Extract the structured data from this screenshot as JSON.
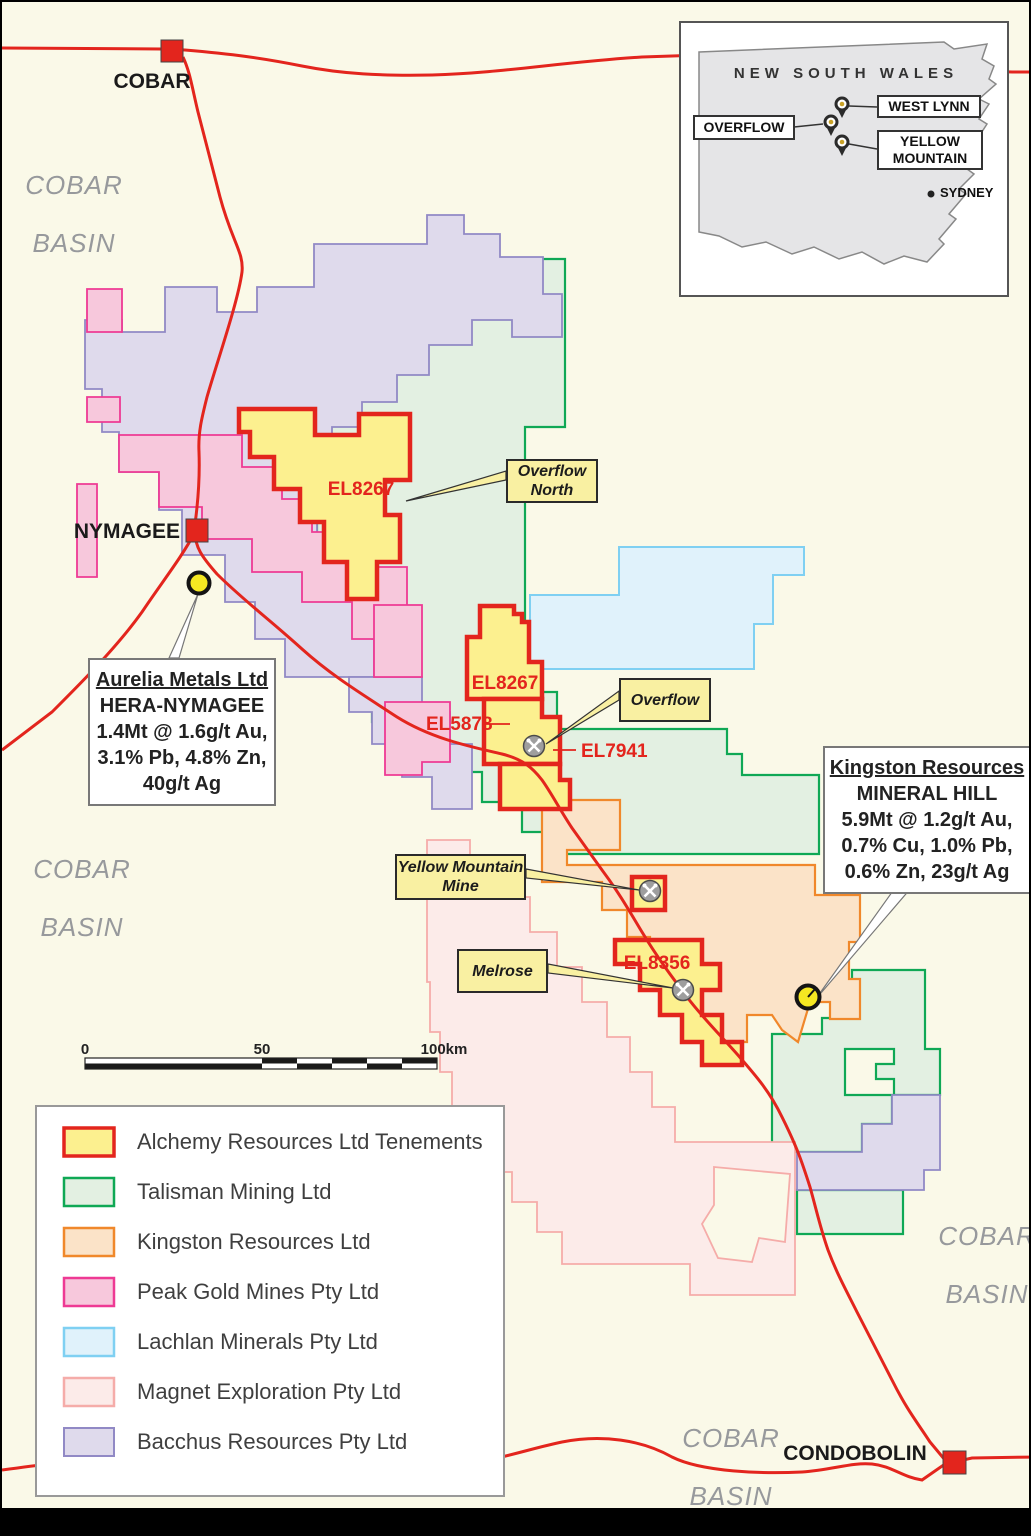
{
  "colors": {
    "background": "#FAF9E8",
    "road": "#E3251D",
    "town_marker": "#E3251D",
    "el_label": "#E3251D",
    "basin_label": "#97999C",
    "callout_fill": "#F9F0A2",
    "deposit_marker_fill": "#F5E822",
    "mine_symbol_fill": "#9E9E9E",
    "inset_land": "#E5E5E7"
  },
  "inset": {
    "region_label": "NEW SOUTH WALES",
    "pin_labels": [
      "WEST LYNN",
      "OVERFLOW",
      "YELLOW MOUNTAIN"
    ],
    "city_label": "SYDNEY"
  },
  "towns": {
    "cobar": "COBAR",
    "nymagee": "NYMAGEE",
    "condobolin": "CONDOBOLIN"
  },
  "basin_label": {
    "line1": "COBAR",
    "line2": "BASIN"
  },
  "el_labels": {
    "el8267_north": "EL8267",
    "el8267_south": "EL8267",
    "el5878": "EL5878",
    "el7941": "EL7941",
    "el8356": "EL8356"
  },
  "callouts": {
    "overflow_north": "Overflow North",
    "overflow": "Overflow",
    "yellow_mountain_mine": "Yellow Mountain Mine",
    "melrose": "Melrose"
  },
  "deposit_boxes": {
    "aurelia": {
      "company": "Aurelia Metals Ltd",
      "project": "HERA-NYMAGEE",
      "grade1": "1.4Mt @ 1.6g/t Au,",
      "grade2": "3.1% Pb, 4.8% Zn,",
      "grade3": "40g/t Ag"
    },
    "kingston": {
      "company": "Kingston Resources",
      "project": "MINERAL HILL",
      "grade1": "5.9Mt @ 1.2g/t Au,",
      "grade2": "0.7% Cu, 1.0% Pb,",
      "grade3": "0.6% Zn, 23g/t Ag"
    }
  },
  "scale_bar": {
    "start": "0",
    "middle": "50",
    "end": "100km"
  },
  "legend": {
    "items": [
      {
        "label": "Alchemy Resources Ltd Tenements",
        "fill": "#FCF08F",
        "stroke": "#E3251D"
      },
      {
        "label": "Talisman Mining Ltd",
        "fill": "#E3F0E2",
        "stroke": "#0FA855"
      },
      {
        "label": "Kingston Resources Ltd",
        "fill": "#FBE3C8",
        "stroke": "#F0882B"
      },
      {
        "label": "Peak Gold Mines Pty Ltd",
        "fill": "#F7C8DC",
        "stroke": "#EE3A94"
      },
      {
        "label": "Lachlan Minerals Pty Ltd",
        "fill": "#E0F2FB",
        "stroke": "#7FD0F2"
      },
      {
        "label": "Magnet Exploration Pty Ltd",
        "fill": "#FCEBE9",
        "stroke": "#F5ACA9"
      },
      {
        "label": "Bacchus Resources Pty Ltd",
        "fill": "#DFDAEC",
        "stroke": "#9189C5"
      }
    ]
  }
}
